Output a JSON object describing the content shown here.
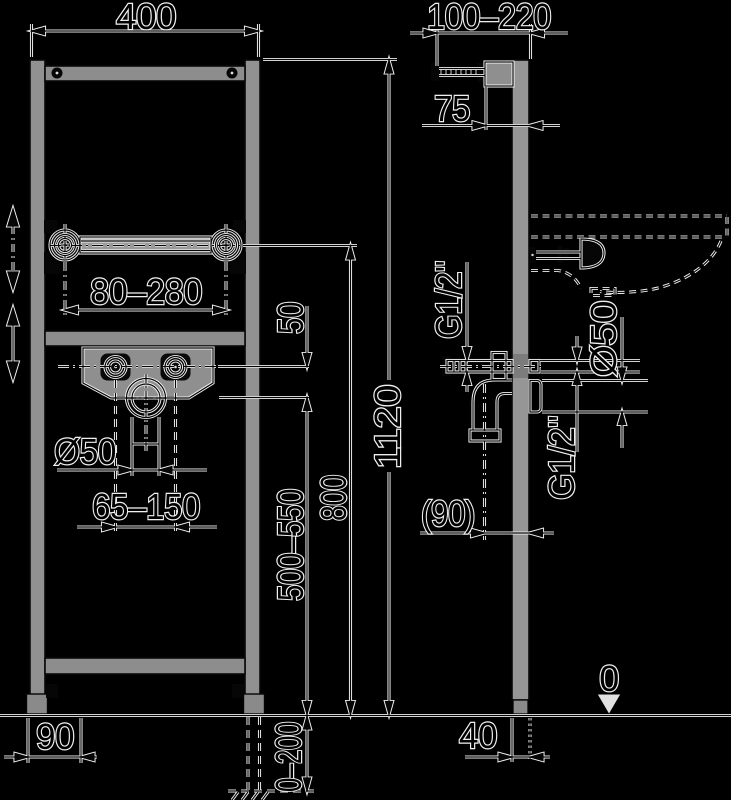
{
  "drawing": {
    "front_view": {
      "frame_width": "400",
      "carrier_range": "80–280",
      "offset_inlet_drain": "50",
      "drain_pipe_dia": "Ø50",
      "tap_spacing": "65–150",
      "drain_height": "500–550",
      "carrier_height": "800",
      "frame_height": "1120",
      "floor_adjust": "0–200",
      "base_depth": "90"
    },
    "side_view": {
      "stud_range": "100–220",
      "bracket_offset": "75",
      "inlet_thread_front": "G1/2\"",
      "inlet_thread_wall": "G1/2\"",
      "outlet_dia": "Ø50",
      "outlet_offset": "(90)",
      "profile_depth": "40",
      "floor_level": "0"
    },
    "colors": {
      "background": "#000000",
      "line": "#f0f0f0",
      "metal": "#919191"
    }
  }
}
